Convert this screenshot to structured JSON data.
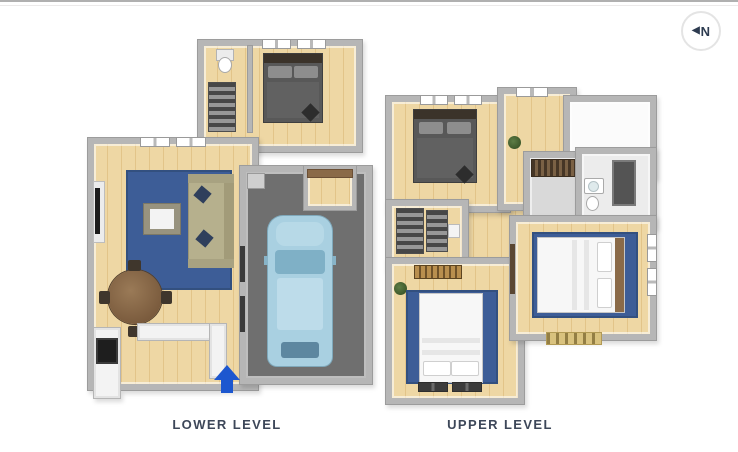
{
  "compass": {
    "arrow": "◀",
    "label": "N"
  },
  "levels": [
    {
      "id": "lower",
      "label": "LOWER LEVEL"
    },
    {
      "id": "upper",
      "label": "UPPER LEVEL"
    }
  ],
  "palette": {
    "wall": "#b6b6b6",
    "wall-edge": "#9c9c9c",
    "wood": "#eed7a4",
    "wood-deep": "#e2c489",
    "garage": "#6f6f6f",
    "rug": "#3d5d97",
    "car": "#a9d0e1",
    "car-glass": "#7fb0c6",
    "bed-dark": "#585858",
    "headboard": "#3b332a",
    "bed-white": "#f7f7f7",
    "sofa": "#b6b08d",
    "table-wood": "#8a6a48",
    "counter": "#f3f3f3",
    "appliance": "#1e1e1e",
    "mat": "#d9c27e",
    "accent": "#1d57cf",
    "label": "#3d4759",
    "rule": "#b0b0b0"
  }
}
